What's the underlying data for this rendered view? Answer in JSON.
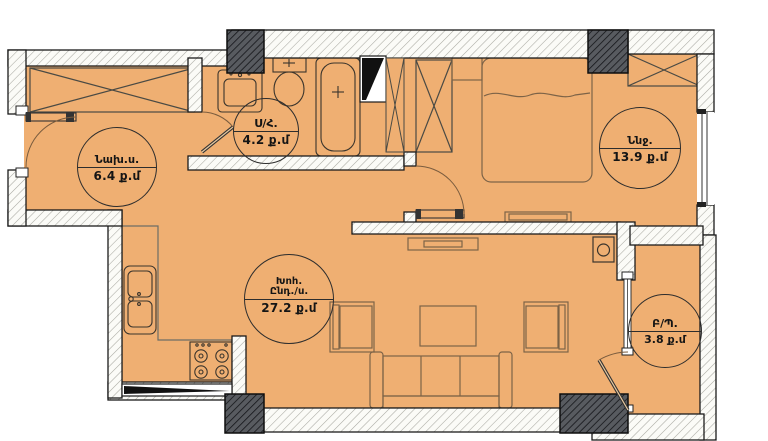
{
  "plan": {
    "type": "apartment-floor-plan",
    "area_unit": "ք.մ",
    "rooms": [
      {
        "id": "hallway",
        "name": "Նախ.ս.",
        "area": "6.4 ք.մ"
      },
      {
        "id": "bathroom",
        "name": "Ս/Հ.",
        "area": "4.2 ք.մ"
      },
      {
        "id": "bedroom",
        "name": "Ննջ.",
        "area": "13.9 ք.մ"
      },
      {
        "id": "living-kitchen",
        "name": "Խոհ.",
        "name2": "Ընդ./ս.",
        "area": "27.2 ք.մ"
      },
      {
        "id": "balcony",
        "name": "Բ/Պ.",
        "area": "3.8 ք.մ"
      }
    ],
    "colors": {
      "floor": "#efaf72",
      "outside": "#ffffff",
      "wall_line": "#1b1b1b",
      "furniture_line": "#7d6347"
    }
  }
}
